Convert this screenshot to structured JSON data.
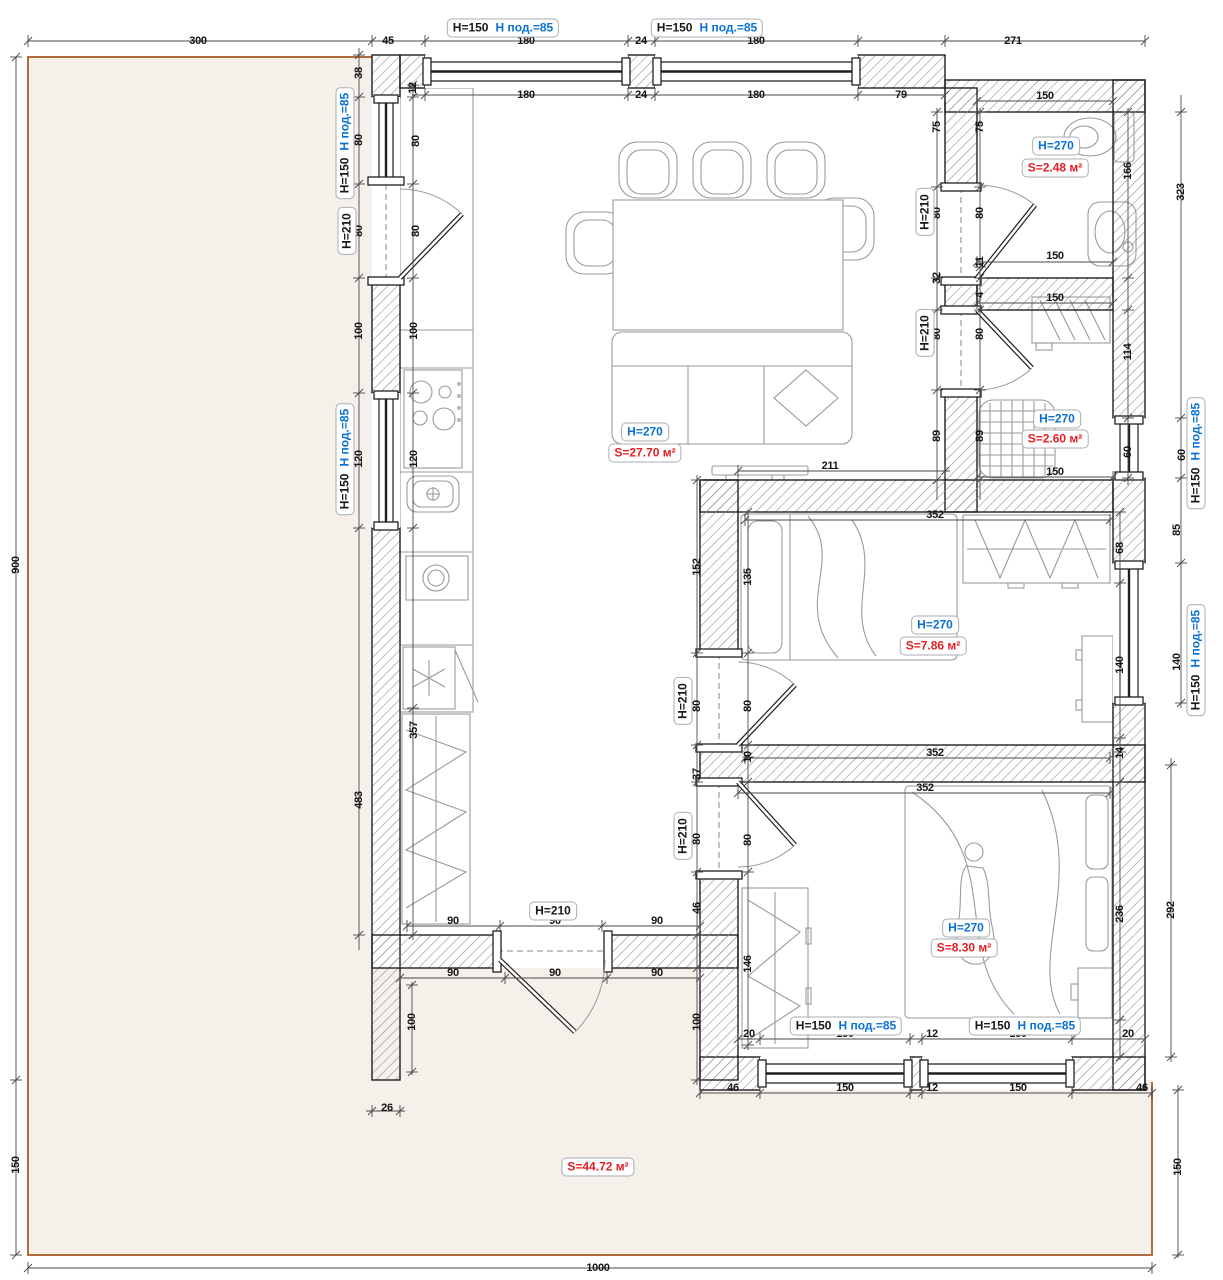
{
  "colors": {
    "blue": "#0a72d4",
    "red": "#e31e24",
    "dim": "#141414",
    "terrace": "#f5f0e9",
    "plotborder": "#b06b3f",
    "wall": "#1f1f1f",
    "hatch": "#8a8a8a",
    "furn": "#9a9a9a",
    "dimline": "#4a4a4a"
  },
  "labels": {
    "rooms": [
      {
        "id": "living-room",
        "h": "H=270",
        "s": "S=27.70 м²",
        "hx": 645,
        "hy": 432,
        "sx": 645,
        "sy": 453
      },
      {
        "id": "bathroom",
        "h": "H=270",
        "s": "S=2.48 м²",
        "hx": 1056,
        "hy": 146,
        "sx": 1055,
        "sy": 168
      },
      {
        "id": "shower-room",
        "h": "H=270",
        "s": "S=2.60 м²",
        "hx": 1057,
        "hy": 419,
        "sx": 1055,
        "sy": 439
      },
      {
        "id": "bedroom-1",
        "h": "H=270",
        "s": "S=7.86 м²",
        "hx": 935,
        "hy": 625,
        "sx": 933,
        "sy": 646
      },
      {
        "id": "bedroom-2",
        "h": "H=270",
        "s": "S=8.30 м²",
        "hx": 966,
        "hy": 928,
        "sx": 964,
        "sy": 948
      }
    ],
    "terrace": {
      "s": "S=44.72 м²",
      "x": 598,
      "y": 1167
    },
    "window_tags": [
      {
        "h": "H=150",
        "sill": "H под.=85",
        "x": 503,
        "y": 28
      },
      {
        "h": "H=150",
        "sill": "H под.=85",
        "x": 707,
        "y": 28
      },
      {
        "h": "H=150",
        "sill": "H под.=85",
        "x": 345,
        "y": 143,
        "r": 1
      },
      {
        "h": "H=150",
        "sill": "H под.=85",
        "x": 345,
        "y": 459,
        "r": 1
      },
      {
        "h": "H=150",
        "sill": "H под.=85",
        "x": 1196,
        "y": 453,
        "r": 1
      },
      {
        "h": "H=150",
        "sill": "H под.=85",
        "x": 1196,
        "y": 660,
        "r": 1
      },
      {
        "h": "H=150",
        "sill": "H под.=85",
        "x": 846,
        "y": 1026
      },
      {
        "h": "H=150",
        "sill": "H под.=85",
        "x": 1025,
        "y": 1026
      }
    ],
    "door_tags": [
      {
        "text": "H=210",
        "x": 347,
        "y": 231,
        "r": 1
      },
      {
        "text": "H=210",
        "x": 925,
        "y": 212,
        "r": 1
      },
      {
        "text": "H=210",
        "x": 925,
        "y": 333,
        "r": 1
      },
      {
        "text": "H=210",
        "x": 683,
        "y": 701,
        "r": 1
      },
      {
        "text": "H=210",
        "x": 683,
        "y": 836,
        "r": 1
      },
      {
        "text": "H=210",
        "x": 553,
        "y": 911
      }
    ],
    "dims": [
      {
        "t": "300",
        "x": 198,
        "y": 41
      },
      {
        "t": "45",
        "x": 388,
        "y": 41
      },
      {
        "t": "180",
        "x": 526,
        "y": 41
      },
      {
        "t": "24",
        "x": 641,
        "y": 41
      },
      {
        "t": "180",
        "x": 756,
        "y": 41
      },
      {
        "t": "271",
        "x": 1013,
        "y": 41
      },
      {
        "t": "180",
        "x": 526,
        "y": 95
      },
      {
        "t": "24",
        "x": 641,
        "y": 95
      },
      {
        "t": "180",
        "x": 756,
        "y": 95
      },
      {
        "t": "79",
        "x": 901,
        "y": 95
      },
      {
        "t": "38",
        "x": 359,
        "y": 73,
        "r": 1
      },
      {
        "t": "80",
        "x": 359,
        "y": 140,
        "r": 1
      },
      {
        "t": "80",
        "x": 359,
        "y": 231,
        "r": 1
      },
      {
        "t": "100",
        "x": 359,
        "y": 331,
        "r": 1
      },
      {
        "t": "120",
        "x": 359,
        "y": 459,
        "r": 1
      },
      {
        "t": "483",
        "x": 359,
        "y": 800,
        "r": 1
      },
      {
        "t": "12",
        "x": 413,
        "y": 88,
        "r": 1
      },
      {
        "t": "80",
        "x": 416,
        "y": 141,
        "r": 1
      },
      {
        "t": "80",
        "x": 416,
        "y": 231,
        "r": 1
      },
      {
        "t": "100",
        "x": 414,
        "y": 331,
        "r": 1
      },
      {
        "t": "120",
        "x": 414,
        "y": 459,
        "r": 1
      },
      {
        "t": "357",
        "x": 414,
        "y": 730,
        "r": 1
      },
      {
        "t": "900",
        "x": 16,
        "y": 565,
        "r": 1
      },
      {
        "t": "150",
        "x": 16,
        "y": 1165,
        "r": 1
      },
      {
        "t": "150",
        "x": 1178,
        "y": 1167,
        "r": 1
      },
      {
        "t": "1000",
        "x": 598,
        "y": 1268
      },
      {
        "t": "75",
        "x": 937,
        "y": 127,
        "r": 1
      },
      {
        "t": "80",
        "x": 937,
        "y": 213,
        "r": 1
      },
      {
        "t": "32",
        "x": 937,
        "y": 278,
        "r": 1
      },
      {
        "t": "80",
        "x": 937,
        "y": 334,
        "r": 1
      },
      {
        "t": "89",
        "x": 937,
        "y": 436,
        "r": 1
      },
      {
        "t": "75",
        "x": 980,
        "y": 127,
        "r": 1
      },
      {
        "t": "80",
        "x": 980,
        "y": 213,
        "r": 1
      },
      {
        "t": "11",
        "x": 980,
        "y": 262,
        "r": 1
      },
      {
        "t": "4",
        "x": 980,
        "y": 295,
        "r": 1
      },
      {
        "t": "80",
        "x": 980,
        "y": 334,
        "r": 1
      },
      {
        "t": "89",
        "x": 980,
        "y": 436,
        "r": 1
      },
      {
        "t": "150",
        "x": 1045,
        "y": 96
      },
      {
        "t": "166",
        "x": 1128,
        "y": 171,
        "r": 1
      },
      {
        "t": "150",
        "x": 1055,
        "y": 256
      },
      {
        "t": "323",
        "x": 1181,
        "y": 192,
        "r": 1
      },
      {
        "t": "150",
        "x": 1055,
        "y": 298
      },
      {
        "t": "114",
        "x": 1128,
        "y": 352,
        "r": 1
      },
      {
        "t": "60",
        "x": 1128,
        "y": 452,
        "r": 1
      },
      {
        "t": "150",
        "x": 1055,
        "y": 472
      },
      {
        "t": "60",
        "x": 1182,
        "y": 455,
        "r": 1
      },
      {
        "t": "85",
        "x": 1177,
        "y": 530,
        "r": 1
      },
      {
        "t": "140",
        "x": 1177,
        "y": 662,
        "r": 1
      },
      {
        "t": "68",
        "x": 1120,
        "y": 548,
        "r": 1
      },
      {
        "t": "140",
        "x": 1120,
        "y": 665,
        "r": 1
      },
      {
        "t": "14",
        "x": 1120,
        "y": 753,
        "r": 1
      },
      {
        "t": "236",
        "x": 1120,
        "y": 914,
        "r": 1
      },
      {
        "t": "292",
        "x": 1171,
        "y": 910,
        "r": 1
      },
      {
        "t": "211",
        "x": 830,
        "y": 466
      },
      {
        "t": "352",
        "x": 935,
        "y": 515
      },
      {
        "t": "352",
        "x": 935,
        "y": 753
      },
      {
        "t": "352",
        "x": 925,
        "y": 788
      },
      {
        "t": "152",
        "x": 697,
        "y": 567,
        "r": 1
      },
      {
        "t": "135",
        "x": 748,
        "y": 577,
        "r": 1
      },
      {
        "t": "80",
        "x": 697,
        "y": 706,
        "r": 1
      },
      {
        "t": "80",
        "x": 748,
        "y": 706,
        "r": 1
      },
      {
        "t": "10",
        "x": 748,
        "y": 757,
        "r": 1
      },
      {
        "t": "37",
        "x": 697,
        "y": 774,
        "r": 1
      },
      {
        "t": "80",
        "x": 697,
        "y": 839,
        "r": 1
      },
      {
        "t": "80",
        "x": 748,
        "y": 840,
        "r": 1
      },
      {
        "t": "46",
        "x": 697,
        "y": 908,
        "r": 1
      },
      {
        "t": "146",
        "x": 748,
        "y": 964,
        "r": 1
      },
      {
        "t": "100",
        "x": 697,
        "y": 1022,
        "r": 1
      },
      {
        "t": "100",
        "x": 412,
        "y": 1022,
        "r": 1
      },
      {
        "t": "90",
        "x": 453,
        "y": 921
      },
      {
        "t": "90",
        "x": 555,
        "y": 921
      },
      {
        "t": "90",
        "x": 657,
        "y": 921
      },
      {
        "t": "90",
        "x": 453,
        "y": 973
      },
      {
        "t": "90",
        "x": 555,
        "y": 973
      },
      {
        "t": "90",
        "x": 657,
        "y": 973
      },
      {
        "t": "26",
        "x": 387,
        "y": 1108
      },
      {
        "t": "20",
        "x": 749,
        "y": 1034
      },
      {
        "t": "150",
        "x": 845,
        "y": 1034
      },
      {
        "t": "12",
        "x": 932,
        "y": 1034
      },
      {
        "t": "150",
        "x": 1018,
        "y": 1034
      },
      {
        "t": "20",
        "x": 1128,
        "y": 1034
      },
      {
        "t": "46",
        "x": 733,
        "y": 1088
      },
      {
        "t": "150",
        "x": 845,
        "y": 1088
      },
      {
        "t": "12",
        "x": 932,
        "y": 1088
      },
      {
        "t": "150",
        "x": 1018,
        "y": 1088
      },
      {
        "t": "46",
        "x": 1142,
        "y": 1088
      }
    ]
  }
}
